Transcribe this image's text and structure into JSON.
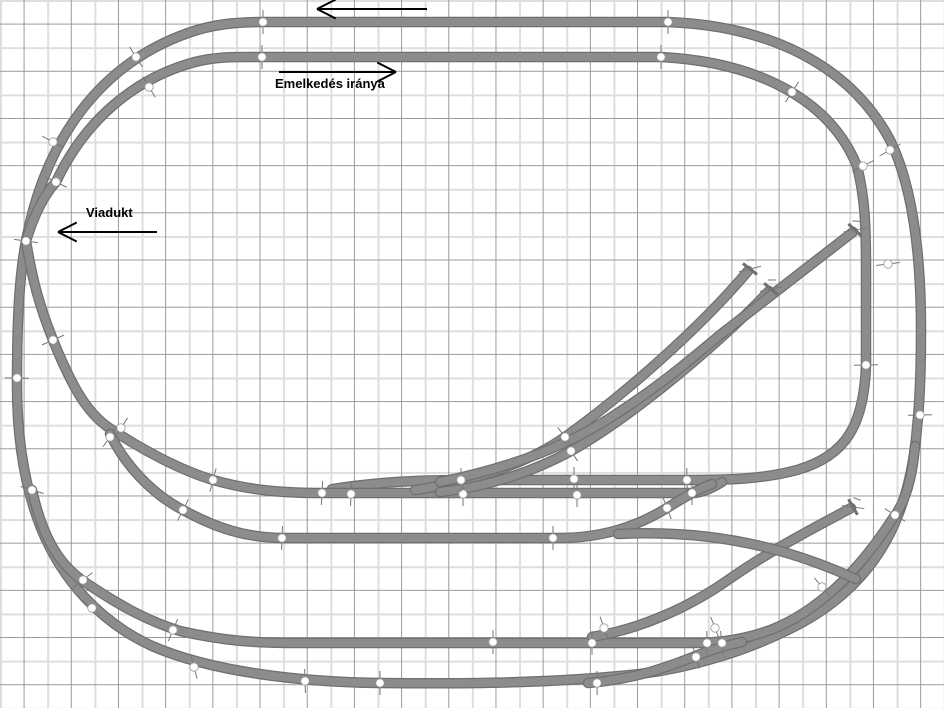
{
  "labels": {
    "incline": "Emelkedés iránya",
    "viaduct": "Viadukt"
  },
  "diagram": {
    "track_color": "#8c8c8c",
    "track_edge_color": "#6f6f6f",
    "joint_fill": "#ffffff",
    "joint_ring": "#999999",
    "joint_tick_color": "#777777",
    "arrow_color": "#000000",
    "tracks": [
      {
        "name": "outer-loop",
        "d": "M 263 22 L 668 22 C 770 26 850 65 890 140 C 912 185 921 250 921 330 C 921 372 920 400 917 428 C 910 515 878 580 803 622 C 748 652 688 668 640 674 C 556 683 470 684 380 683 C 300 682 212 672 152 646 C 100 622 62 580 41 528 C 25 488 17 440 17 385 C 17 320 19 278 26 241 C 45 140 100 64 188 33 C 213 24 238 22 263 22"
      },
      {
        "name": "inner-loop-incline",
        "d": "M 26 241 C 34 215 44 195 56 182 C 85 120 135 78 195 62 C 218 56 240 57 262 57 L 661 57 C 758 62 830 100 857 166 C 865 198 866 225 866 270 L 866 365 C 864 425 846 456 797 470 C 764 479 730 480 688 480 L 462 480 C 415 480 370 483 332 489"
      },
      {
        "name": "descent-to-station-1",
        "d": "M 26 241 C 32 278 39 305 53 340 C 74 392 90 417 114 431 C 143 450 180 470 213 480 C 252 491 285 493 322 493 L 692 493 C 702 493 712 488 722 482"
      },
      {
        "name": "descent-to-station-2",
        "d": "M 110 434 C 125 465 152 494 183 510 C 216 528 246 538 284 538 L 558 538 C 602 538 636 527 667 508 C 683 498 698 489 712 484"
      },
      {
        "name": "siding-1",
        "d": "M 415 490 C 475 481 530 462 565 437 C 625 394 700 328 748 271"
      },
      {
        "name": "siding-2",
        "d": "M 440 492 C 495 486 540 468 571 451 C 628 419 715 348 769 291"
      },
      {
        "name": "siding-3",
        "d": "M 440 482 C 500 470 560 450 610 418 C 660 386 690 360 720 335 L 853 232"
      },
      {
        "name": "lower-yard-line",
        "d": "M 32 490 C 44 543 62 567 86 583 C 122 607 148 621 180 631 C 224 641 254 643 300 643 L 700 643 C 762 641 802 621 843 581 C 872 552 886 528 896 514 C 908 496 913 470 915 446"
      },
      {
        "name": "yard-connector",
        "d": "M 588 683 C 636 679 668 667 698 655 C 716 648 728 645 742 642"
      },
      {
        "name": "siding-4",
        "d": "M 592 637 C 640 629 688 608 728 580 C 772 549 820 525 851 508"
      },
      {
        "name": "station-yard-link",
        "d": "M 618 534 C 676 531 730 537 780 551 C 812 560 836 570 856 579"
      }
    ],
    "joints": [
      [
        263,
        22,
        0
      ],
      [
        668,
        22,
        0
      ],
      [
        262,
        57,
        0
      ],
      [
        661,
        57,
        0
      ],
      [
        136,
        57,
        -33
      ],
      [
        53,
        142,
        -62
      ],
      [
        149,
        87,
        -31
      ],
      [
        56,
        182,
        -64
      ],
      [
        26,
        241,
        -82
      ],
      [
        17,
        378,
        -89
      ],
      [
        32,
        490,
        -73
      ],
      [
        92,
        608,
        -50
      ],
      [
        194,
        667,
        -15
      ],
      [
        305,
        681,
        -2
      ],
      [
        380,
        683,
        0
      ],
      [
        597,
        683,
        -1
      ],
      [
        696,
        657,
        -17
      ],
      [
        722,
        643,
        -7
      ],
      [
        792,
        92,
        33
      ],
      [
        890,
        150,
        60
      ],
      [
        863,
        166,
        63
      ],
      [
        888,
        264,
        83
      ],
      [
        920,
        415,
        89
      ],
      [
        866,
        365,
        89
      ],
      [
        53,
        340,
        66
      ],
      [
        110,
        437,
        36
      ],
      [
        121,
        428,
        33
      ],
      [
        183,
        510,
        27
      ],
      [
        213,
        480,
        15
      ],
      [
        322,
        493,
        3
      ],
      [
        351,
        494,
        2
      ],
      [
        463,
        494,
        0
      ],
      [
        577,
        495,
        0
      ],
      [
        692,
        493,
        0
      ],
      [
        461,
        480,
        0
      ],
      [
        574,
        479,
        0
      ],
      [
        687,
        480,
        -1
      ],
      [
        282,
        538,
        2
      ],
      [
        553,
        538,
        0
      ],
      [
        667,
        508,
        -21
      ],
      [
        565,
        437,
        -37
      ],
      [
        571,
        451,
        -33
      ],
      [
        83,
        580,
        52
      ],
      [
        173,
        630,
        23
      ],
      [
        493,
        642,
        0
      ],
      [
        592,
        643,
        0
      ],
      [
        707,
        643,
        -1
      ],
      [
        822,
        587,
        -40
      ],
      [
        895,
        515,
        -58
      ],
      [
        604,
        628,
        -19
      ],
      [
        715,
        628,
        -21
      ]
    ],
    "buffers": [
      [
        750,
        269,
        -52
      ],
      [
        771,
        289,
        -50
      ],
      [
        855,
        230,
        -47
      ],
      [
        853,
        507,
        -30
      ]
    ],
    "arrows": [
      {
        "name": "arrow-left-top",
        "x1": 427,
        "y1": 9,
        "x2": 317,
        "y2": 9
      },
      {
        "name": "arrow-incline-direction",
        "x1": 279,
        "y1": 72,
        "x2": 396,
        "y2": 72
      },
      {
        "name": "arrow-viaduct",
        "x1": 157,
        "y1": 232,
        "x2": 58,
        "y2": 232
      }
    ]
  }
}
